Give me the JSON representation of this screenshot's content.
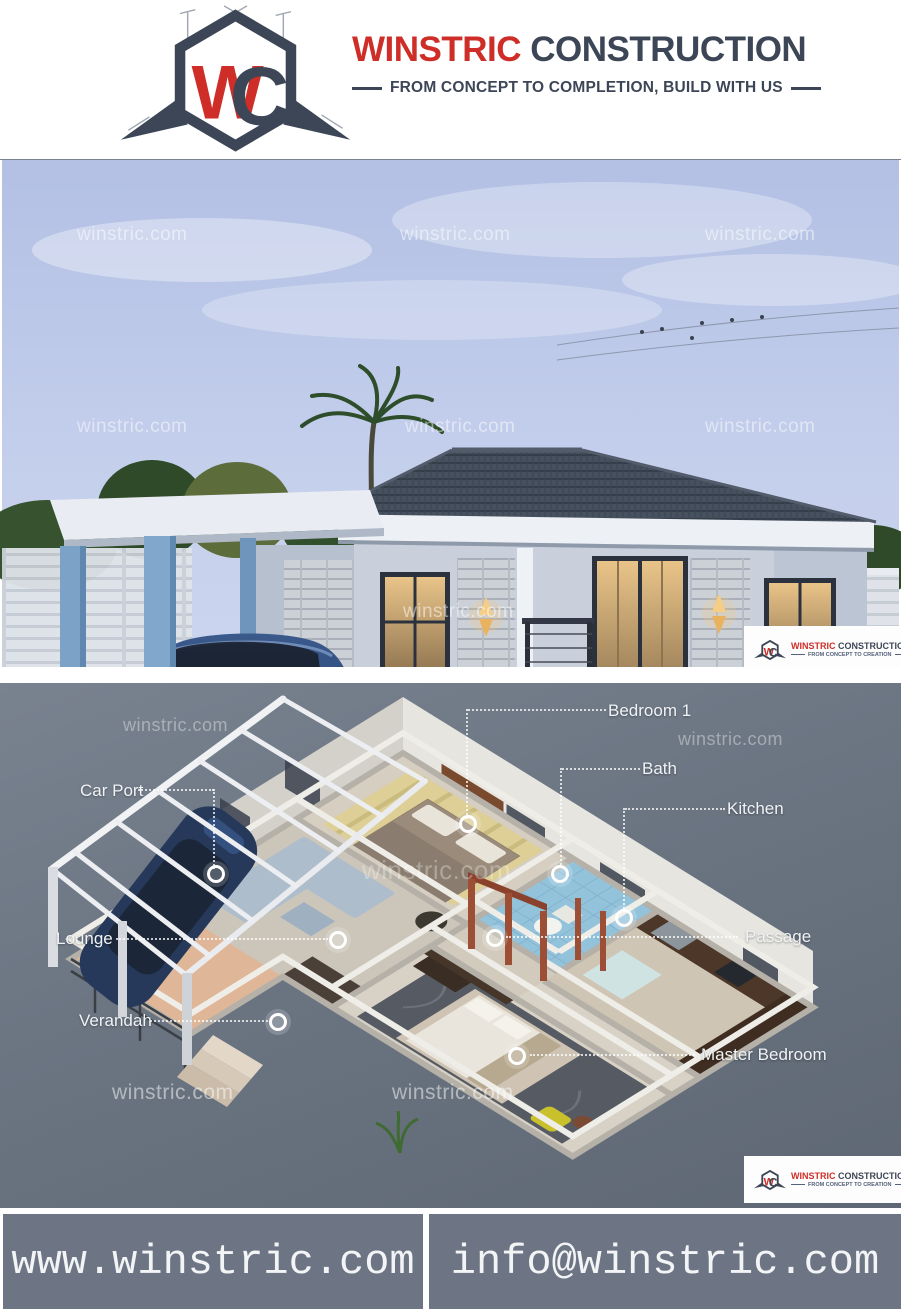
{
  "brand": {
    "name_primary": "WINSTRIC",
    "name_secondary": "CONSTRUCTION",
    "tagline": "FROM CONCEPT TO COMPLETION, BUILD WITH US",
    "monogram_w": "W",
    "monogram_c": "C",
    "colors": {
      "red": "#ce2e27",
      "navy": "#3d4656"
    }
  },
  "watermark": "winstric.com",
  "logo_chip": {
    "name_primary": "WINSTRIC",
    "name_secondary": "CONSTRUCTION",
    "tagline": "FROM CONCEPT TO CREATION"
  },
  "photo_section": {
    "description": "3D exterior render of a modern bungalow with carport and blue VW hatchback"
  },
  "plan_section": {
    "description": "3D isometric floor plan",
    "labels": [
      {
        "text": "Bedroom 1"
      },
      {
        "text": "Bath"
      },
      {
        "text": "Kitchen"
      },
      {
        "text": "Car Port"
      },
      {
        "text": "Lounge"
      },
      {
        "text": "Verandah"
      },
      {
        "text": "Passage"
      },
      {
        "text": "Master Bedroom"
      }
    ],
    "colors": {
      "background": "#6b7582",
      "door_frames": "#9d4f36"
    }
  },
  "footer": {
    "website": "www.winstric.com",
    "email": "info@winstric.com",
    "background": "#6d7584"
  }
}
